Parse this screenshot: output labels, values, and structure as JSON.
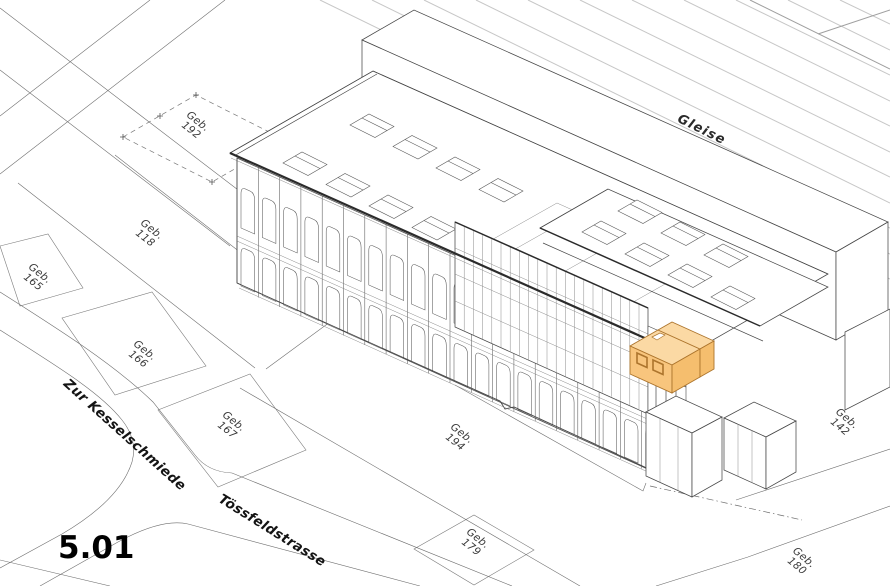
{
  "sheet": {
    "number": "5.01"
  },
  "area": {
    "railway": "Gleise"
  },
  "streets": {
    "kesselschmiede": "Zur Kesselschmiede",
    "toessfeldstrasse": "Tössfeldstrasse"
  },
  "plots": {
    "geb192": {
      "l1": "Geb.",
      "l2": "192"
    },
    "geb118": {
      "l1": "Geb.",
      "l2": "118"
    },
    "geb165": {
      "l1": "Geb.",
      "l2": "165"
    },
    "geb166": {
      "l1": "Geb.",
      "l2": "166"
    },
    "geb167": {
      "l1": "Geb.",
      "l2": "167"
    },
    "geb194": {
      "l1": "Geb.",
      "l2": "194"
    },
    "geb179": {
      "l1": "Geb.",
      "l2": "179"
    },
    "geb142": {
      "l1": "Geb.",
      "l2": "142"
    },
    "geb180": {
      "l1": "Geb.",
      "l2": "180"
    }
  },
  "highlight": {
    "unit": "5.01",
    "top": "#FBD9A4",
    "front": "#F8C57D",
    "side": "#F5BE6E",
    "stroke": "#AD752D"
  },
  "colors": {
    "track": "#c7c7c7",
    "track_dark": "#9f9f9f",
    "line": "#555555",
    "eaves": "#2b2b2b"
  }
}
